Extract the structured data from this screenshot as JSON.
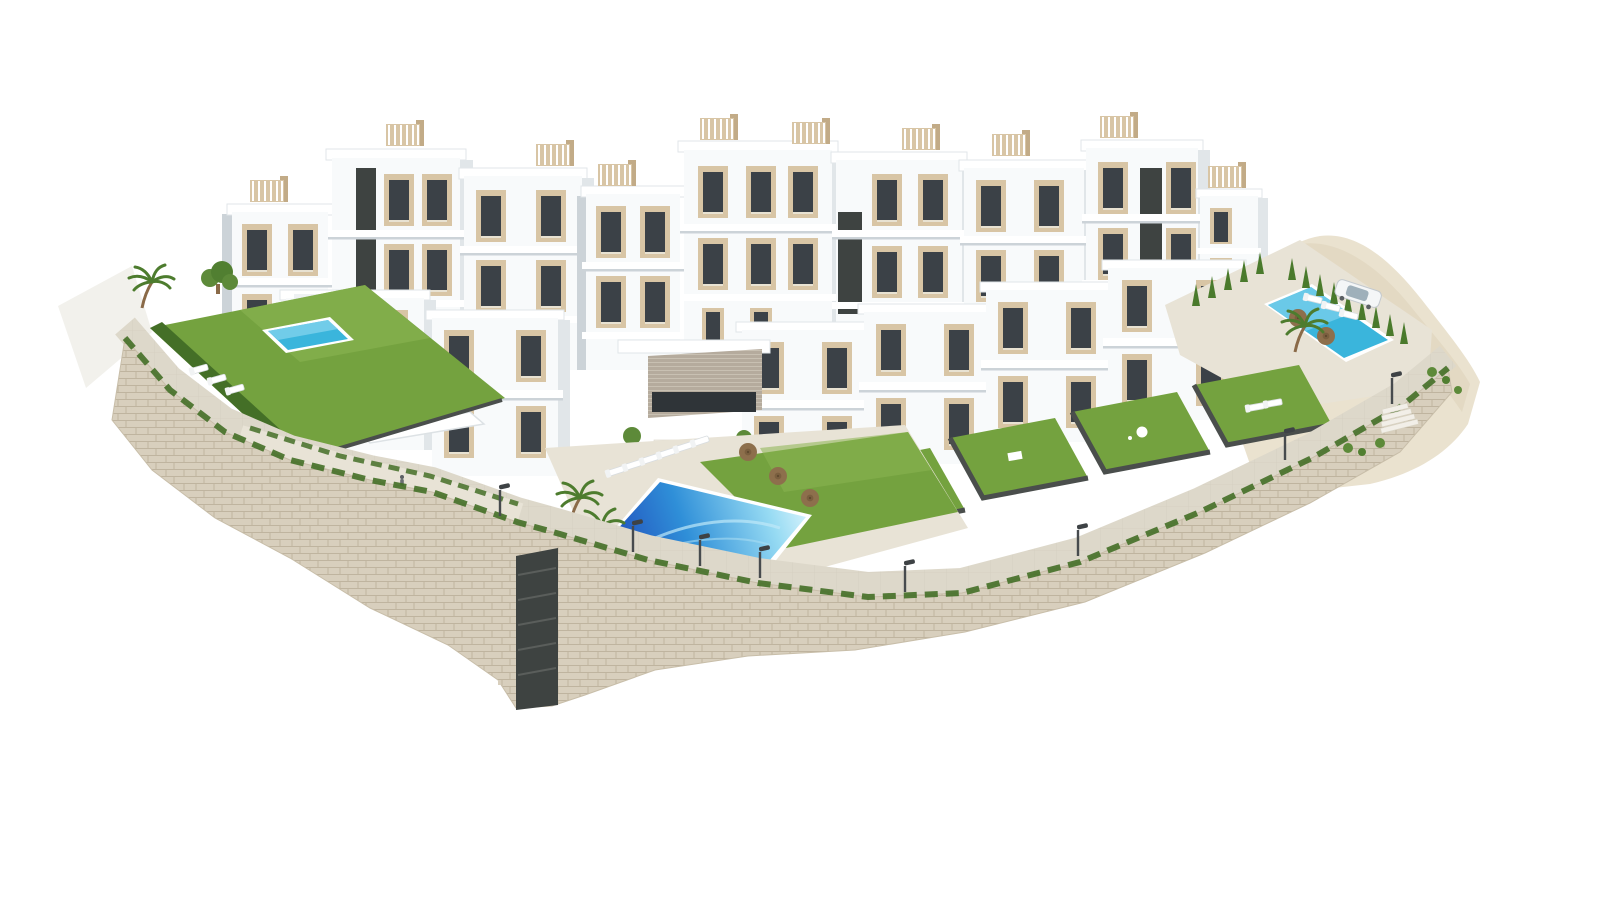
{
  "scene": {
    "title": "Aerial 3D render of a white hillside apartment complex",
    "description": "Isometric aerial architectural rendering on a white background: stepped modern white apartment blocks with beige accent panels, dark glazing, rooftop pergolas, private lawn gardens, a large central communal pool with sun loungers and brown parasols, a small private pool on the left garden, a second communal pool with a parked white car on the right, palm trees, cypress hedges, street lamps along a promenade, and a long curved natural-stone retaining wall wrapping the whole plot.",
    "elements": [
      "apartment-blocks",
      "rooftop-pergolas",
      "central-pool",
      "left-garden-pool",
      "right-pool",
      "stone-retaining-wall",
      "promenade-walkway",
      "street-lamps",
      "cypress-hedges",
      "palm-trees",
      "sun-loungers",
      "parasols",
      "private-gardens",
      "clubhouse-stairs",
      "parked-car",
      "pedestrians",
      "natural-terrain-slope"
    ],
    "counts": {
      "pools": 3,
      "parked_cars": 1,
      "parasols": 5,
      "street_lamps": 8
    }
  },
  "colors": {
    "bg": "#ffffff",
    "bldg_front": "#f8fafb",
    "bldg_side": "#e1e6e9",
    "bldg_shade": "#ccd3d8",
    "panel": "#d8c5a5",
    "panel_dark": "#c2ab87",
    "win": "#3b4147",
    "dark": "#3e4341",
    "grass": "#74a23f",
    "grass_light": "#8ab452",
    "hedge": "#446f27",
    "cypress": "#4a7a2c",
    "pool_deep": "#1e3eb5",
    "pool_mid": "#2f8fd8",
    "pool_light": "#97dbf3",
    "pool_small": "#3ab5dc",
    "stone": "#d8cfbd",
    "stone_line": "#b9ae97",
    "paving": "#ddd8ca",
    "paving_light": "#e8e3d6",
    "terrain": "#eae2cf",
    "terrain_dark": "#dcd2b9",
    "wood": "#c7ab7d",
    "parasol": "#8d6f4c",
    "trunk": "#8a6a48",
    "car_body": "#f4f6f7",
    "car_glass": "#9fb0ba",
    "fence_dark": "#4a4e4c"
  }
}
